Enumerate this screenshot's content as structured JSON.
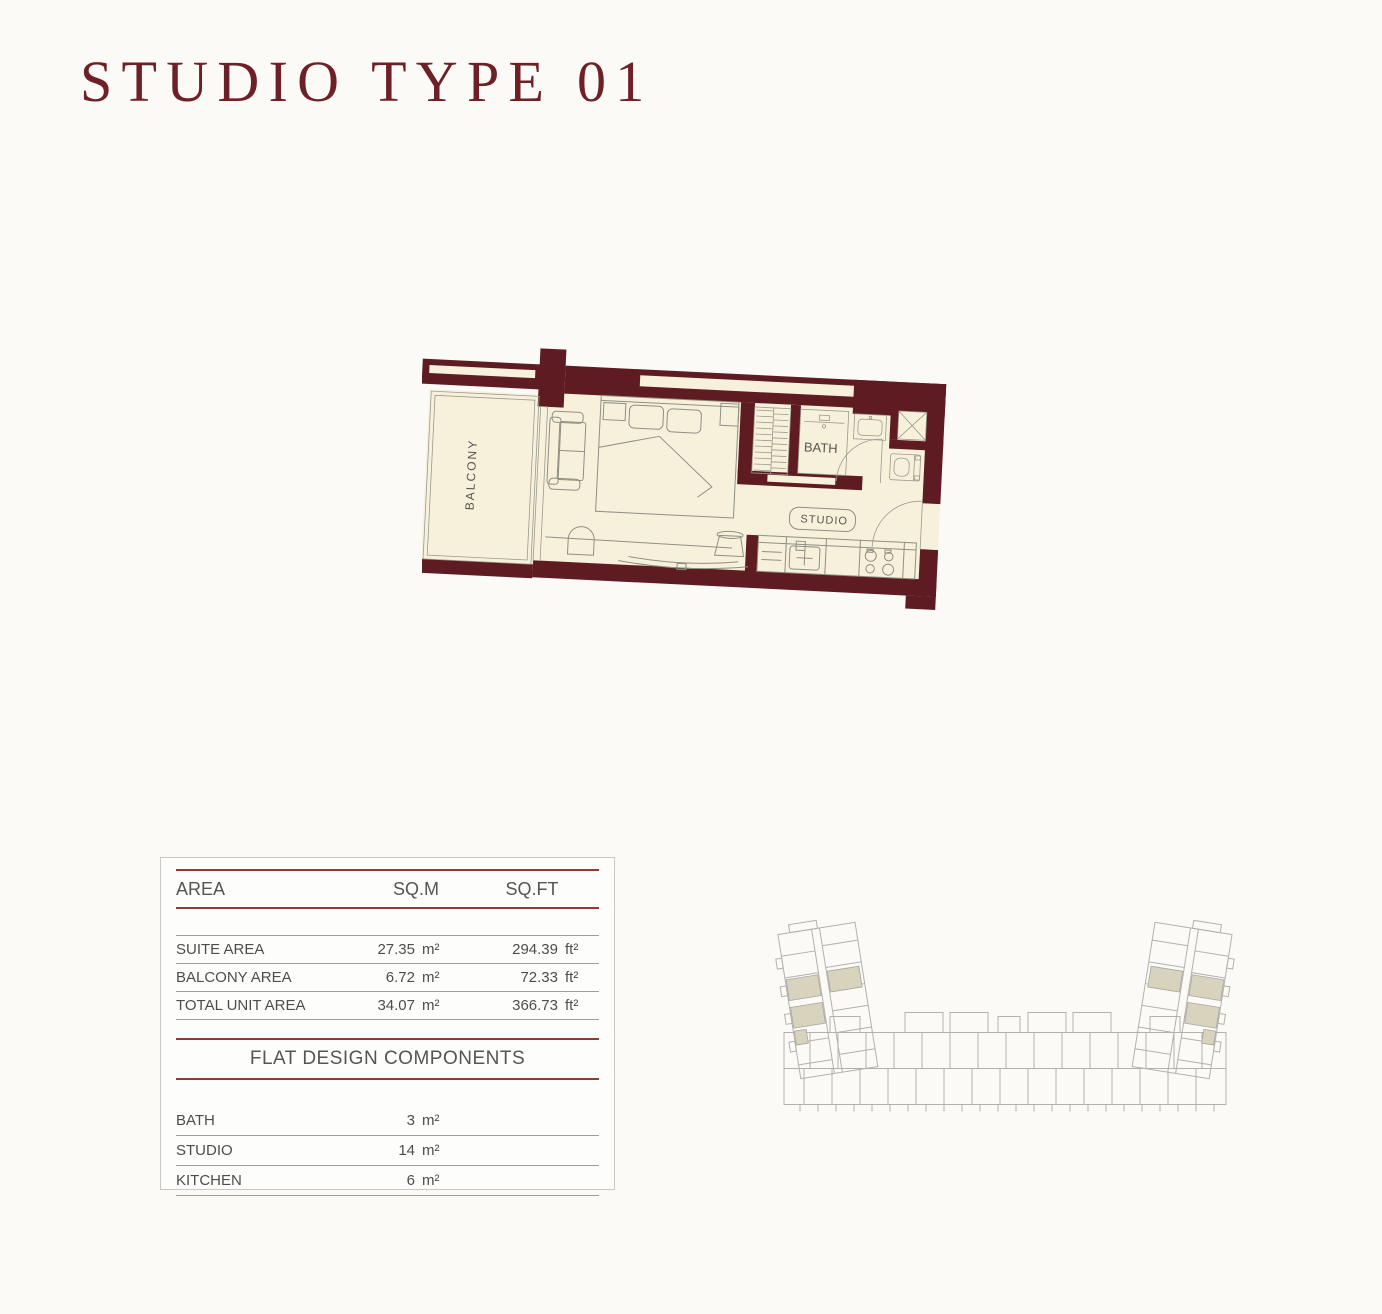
{
  "page": {
    "title": "STUDIO TYPE 01"
  },
  "colors": {
    "wall_maroon": "#5e1b21",
    "title_maroon": "#6e2027",
    "table_line_maroon": "#8d3c38",
    "floor_cream": "#f7f1dc",
    "keyplan_highlight": "#d8d3bd"
  },
  "floor_plan": {
    "labels": {
      "balcony": "BALCONY",
      "bath": "BATH",
      "studio": "STUDIO"
    }
  },
  "area_table": {
    "headers": {
      "area": "AREA",
      "sqm": "SQ.M",
      "sqft": "SQ.FT"
    },
    "rows": [
      {
        "label": "SUITE AREA",
        "sqm": "27.35",
        "sqm_unit": "m²",
        "sqft": "294.39",
        "sqft_unit": "ft²"
      },
      {
        "label": "BALCONY AREA",
        "sqm": "6.72",
        "sqm_unit": "m²",
        "sqft": "72.33",
        "sqft_unit": "ft²"
      },
      {
        "label": "TOTAL UNIT AREA",
        "sqm": "34.07",
        "sqm_unit": "m²",
        "sqft": "366.73",
        "sqft_unit": "ft²"
      }
    ],
    "components": {
      "title": "FLAT DESIGN COMPONENTS",
      "rows": [
        {
          "label": "BATH",
          "value": "3",
          "unit": "m²"
        },
        {
          "label": "STUDIO",
          "value": "14",
          "unit": "m²"
        },
        {
          "label": "KITCHEN",
          "value": "6",
          "unit": "m²"
        }
      ]
    }
  }
}
